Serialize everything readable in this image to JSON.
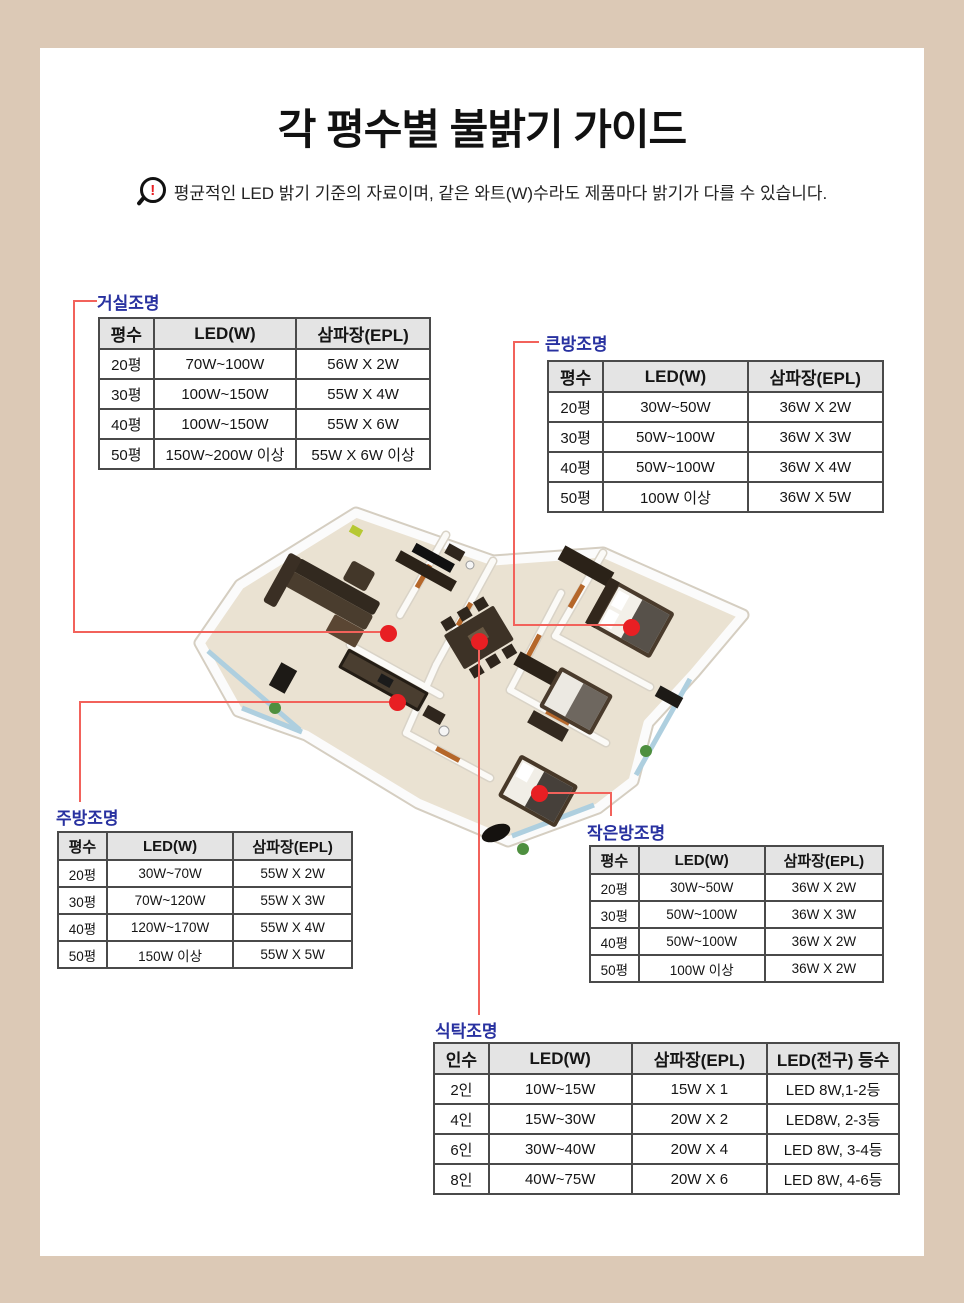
{
  "page": {
    "title": "각 평수별 불밝기 가이드",
    "notice": "평균적인 LED 밝기 기준의 자료이며, 같은 와트(W)수라도 제품마다 밝기가 다를 수 있습니다.",
    "notice_icon_glyph": "!"
  },
  "colors": {
    "background": "#dcc9b6",
    "panel": "#ffffff",
    "label_blue": "#2831a0",
    "connector_red": "#f2625b",
    "marker_red": "#e81f23",
    "table_header_bg": "#e4e4e4",
    "table_border": "#3a3a3a"
  },
  "tables": {
    "living": {
      "label": "거실조명",
      "headers": [
        "평수",
        "LED(W)",
        "삼파장(EPL)"
      ],
      "rows": [
        [
          "20평",
          "70W~100W",
          "56W X 2W"
        ],
        [
          "30평",
          "100W~150W",
          "55W X 4W"
        ],
        [
          "40평",
          "100W~150W",
          "55W X 6W"
        ],
        [
          "50평",
          "150W~200W 이상",
          "55W X 6W 이상"
        ]
      ]
    },
    "big_room": {
      "label": "큰방조명",
      "headers": [
        "평수",
        "LED(W)",
        "삼파장(EPL)"
      ],
      "rows": [
        [
          "20평",
          "30W~50W",
          "36W X 2W"
        ],
        [
          "30평",
          "50W~100W",
          "36W X 3W"
        ],
        [
          "40평",
          "50W~100W",
          "36W X 4W"
        ],
        [
          "50평",
          "100W 이상",
          "36W X 5W"
        ]
      ]
    },
    "kitchen": {
      "label": "주방조명",
      "headers": [
        "평수",
        "LED(W)",
        "삼파장(EPL)"
      ],
      "rows": [
        [
          "20평",
          "30W~70W",
          "55W X 2W"
        ],
        [
          "30평",
          "70W~120W",
          "55W X 3W"
        ],
        [
          "40평",
          "120W~170W",
          "55W X 4W"
        ],
        [
          "50평",
          "150W 이상",
          "55W X 5W"
        ]
      ]
    },
    "small_room": {
      "label": "작은방조명",
      "headers": [
        "평수",
        "LED(W)",
        "삼파장(EPL)"
      ],
      "rows": [
        [
          "20평",
          "30W~50W",
          "36W X 2W"
        ],
        [
          "30평",
          "50W~100W",
          "36W X 3W"
        ],
        [
          "40평",
          "50W~100W",
          "36W X 2W"
        ],
        [
          "50평",
          "100W 이상",
          "36W X 2W"
        ]
      ]
    },
    "dining": {
      "label": "식탁조명",
      "headers": [
        "인수",
        "LED(W)",
        "삼파장(EPL)",
        "LED(전구) 등수"
      ],
      "rows": [
        [
          "2인",
          "10W~15W",
          "15W X 1",
          "LED 8W,1-2등"
        ],
        [
          "4인",
          "15W~30W",
          "20W X 2",
          "LED8W, 2-3등"
        ],
        [
          "6인",
          "30W~40W",
          "20W X 4",
          "LED 8W, 3-4등"
        ],
        [
          "8인",
          "40W~75W",
          "20W X 6",
          "LED 8W, 4-6등"
        ]
      ]
    }
  },
  "floorplan": {
    "markers": [
      "living-room",
      "dining-table",
      "master-bedroom",
      "kitchen",
      "small-bedroom"
    ]
  }
}
